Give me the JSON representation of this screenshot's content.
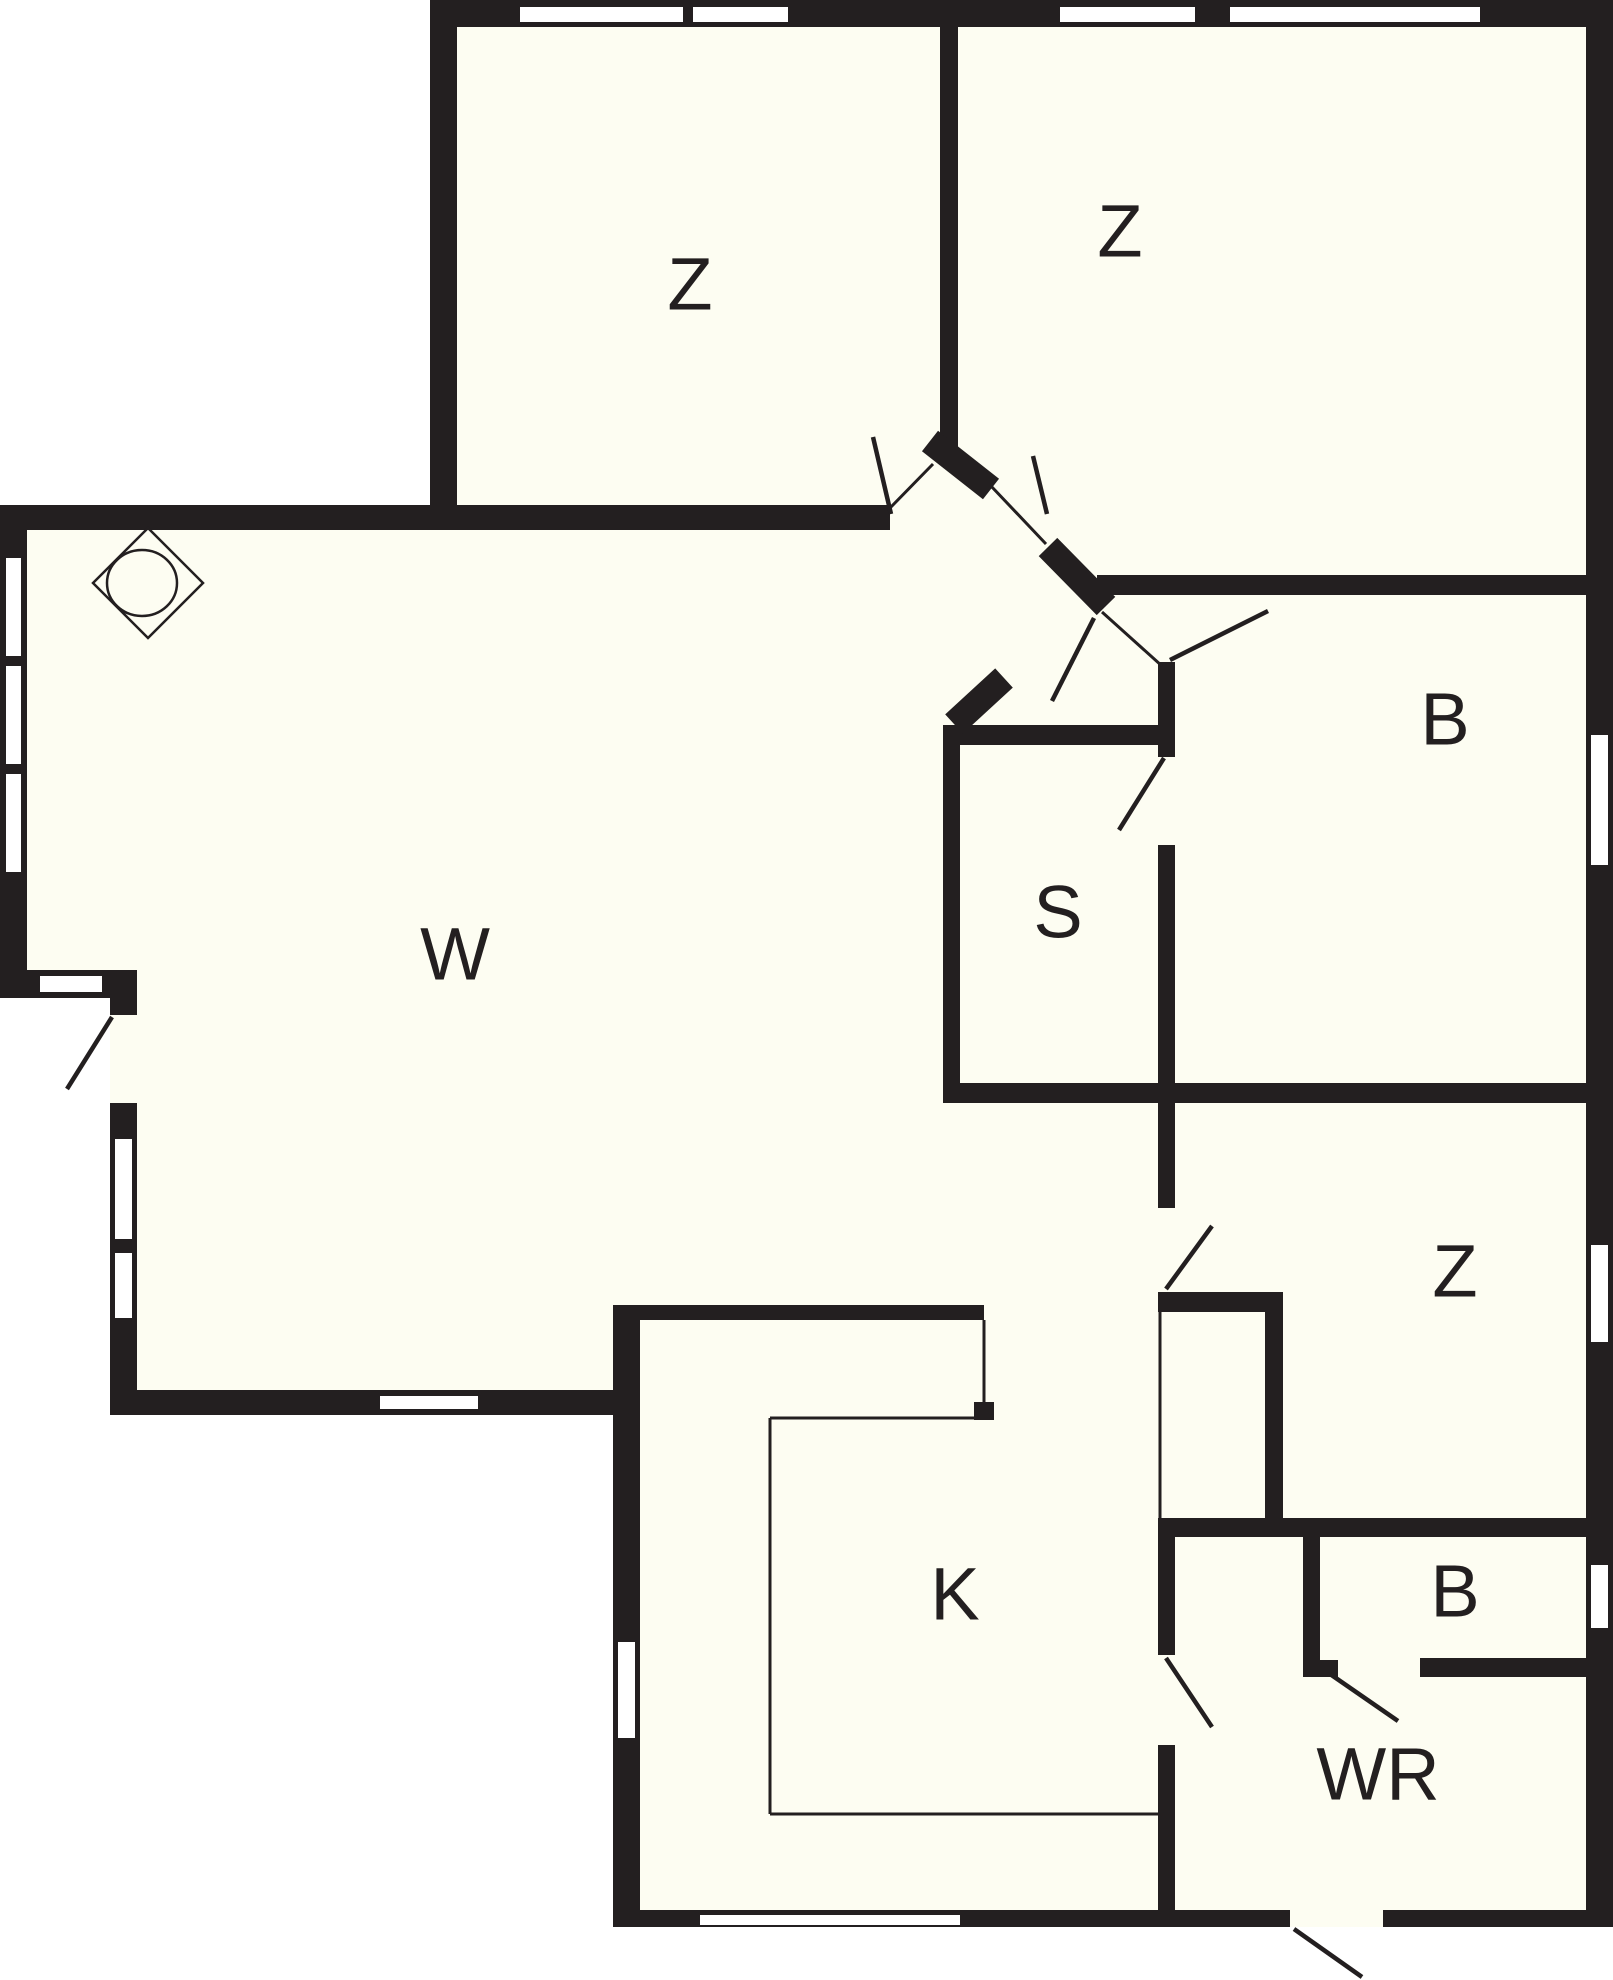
{
  "plan_title": "floor-plan",
  "canvas": {
    "width": 1613,
    "height": 1980
  },
  "colors": {
    "wall": "#231f20",
    "floor": "#fdfdf2",
    "outside": "#ffffff",
    "window": "#ffffff"
  },
  "label_font_size": 74,
  "rooms": [
    {
      "id": "bedroom-1",
      "label": "Z",
      "x": 690,
      "y": 290
    },
    {
      "id": "bedroom-2",
      "label": "Z",
      "x": 1120,
      "y": 237
    },
    {
      "id": "living-room",
      "label": "W",
      "x": 455,
      "y": 960
    },
    {
      "id": "sauna",
      "label": "S",
      "x": 1058,
      "y": 918
    },
    {
      "id": "bathroom-1",
      "label": "B",
      "x": 1445,
      "y": 725
    },
    {
      "id": "bedroom-3",
      "label": "Z",
      "x": 1455,
      "y": 1277
    },
    {
      "id": "kitchen",
      "label": "K",
      "x": 955,
      "y": 1600
    },
    {
      "id": "bathroom-2",
      "label": "B",
      "x": 1455,
      "y": 1597
    },
    {
      "id": "utility-room",
      "label": "WR",
      "x": 1378,
      "y": 1780
    }
  ],
  "floor_outline": [
    [
      430,
      0
    ],
    [
      1613,
      0
    ],
    [
      1613,
      1927
    ],
    [
      613,
      1927
    ],
    [
      613,
      1415
    ],
    [
      110,
      1415
    ],
    [
      110,
      998
    ],
    [
      0,
      998
    ],
    [
      0,
      505
    ],
    [
      430,
      505
    ]
  ],
  "walls": [
    {
      "name": "outer-top-wall",
      "x": 430,
      "y": 0,
      "w": 1183,
      "h": 27
    },
    {
      "name": "outer-right-wall",
      "x": 1586,
      "y": 0,
      "w": 27,
      "h": 1927
    },
    {
      "name": "bedroom1-left-wall",
      "x": 430,
      "y": 0,
      "w": 27,
      "h": 530
    },
    {
      "name": "living-top-wall",
      "x": 0,
      "y": 505,
      "w": 890,
      "h": 25
    },
    {
      "name": "living-left-wall",
      "x": 0,
      "y": 505,
      "w": 27,
      "h": 493
    },
    {
      "name": "living-step-wall",
      "x": 0,
      "y": 970,
      "w": 137,
      "h": 28
    },
    {
      "name": "lowleft-wall-a",
      "x": 110,
      "y": 998,
      "w": 27,
      "h": 17
    },
    {
      "name": "lowleft-wall-b",
      "x": 110,
      "y": 1103,
      "w": 27,
      "h": 312
    },
    {
      "name": "living-bottom-wall",
      "x": 110,
      "y": 1390,
      "w": 530,
      "h": 25
    },
    {
      "name": "kitchen-left-wall",
      "x": 613,
      "y": 1305,
      "w": 27,
      "h": 622
    },
    {
      "name": "bottom-wall-west",
      "x": 613,
      "y": 1910,
      "w": 677,
      "h": 17
    },
    {
      "name": "bottom-wall-east",
      "x": 1383,
      "y": 1910,
      "w": 230,
      "h": 17
    },
    {
      "name": "bedroom-divider-wall",
      "x": 940,
      "y": 27,
      "w": 18,
      "h": 420
    },
    {
      "name": "bath1-top-wall",
      "x": 1097,
      "y": 575,
      "w": 516,
      "h": 20
    },
    {
      "name": "sauna-top-wall",
      "x": 943,
      "y": 725,
      "w": 232,
      "h": 20
    },
    {
      "name": "sauna-left-wall",
      "x": 943,
      "y": 725,
      "w": 17,
      "h": 375
    },
    {
      "name": "sauna-right-wall-up",
      "x": 1158,
      "y": 662,
      "w": 17,
      "h": 95
    },
    {
      "name": "sauna-right-wall-low",
      "x": 1158,
      "y": 845,
      "w": 17,
      "h": 255
    },
    {
      "name": "sauna-bath-bottom-wall",
      "x": 943,
      "y": 1083,
      "w": 670,
      "h": 20
    },
    {
      "name": "corridor-east-wall",
      "x": 1158,
      "y": 1103,
      "w": 17,
      "h": 105
    },
    {
      "name": "corridor-stub-wall",
      "x": 1158,
      "y": 1292,
      "w": 125,
      "h": 20
    },
    {
      "name": "closet-right-wall",
      "x": 1265,
      "y": 1312,
      "w": 18,
      "h": 211
    },
    {
      "name": "utility-top-wall",
      "x": 1158,
      "y": 1518,
      "w": 432,
      "h": 19
    },
    {
      "name": "utility-left-wall-a",
      "x": 1158,
      "y": 1537,
      "w": 17,
      "h": 118
    },
    {
      "name": "utility-left-wall-b",
      "x": 1158,
      "y": 1745,
      "w": 17,
      "h": 165
    },
    {
      "name": "bath2-left-wall",
      "x": 1303,
      "y": 1537,
      "w": 17,
      "h": 140
    },
    {
      "name": "bath2-stub-wall",
      "x": 1303,
      "y": 1660,
      "w": 35,
      "h": 17
    },
    {
      "name": "bath2-bottom-wall",
      "x": 1420,
      "y": 1658,
      "w": 170,
      "h": 19
    },
    {
      "name": "kitchen-top-wall",
      "x": 613,
      "y": 1305,
      "w": 371,
      "h": 15
    },
    {
      "name": "kitchen-counter-cap",
      "x": 974,
      "y": 1402,
      "w": 20,
      "h": 18
    }
  ],
  "diagonal_walls": [
    {
      "name": "hall-jamb-a",
      "x1": 930,
      "y1": 441,
      "x2": 991,
      "y2": 489,
      "w": 26
    },
    {
      "name": "hall-jamb-b",
      "x1": 1048,
      "y1": 547,
      "x2": 1106,
      "y2": 606,
      "w": 26
    },
    {
      "name": "hall-jamb-c",
      "x1": 1004,
      "y1": 678,
      "x2": 954,
      "y2": 724,
      "w": 26
    }
  ],
  "thin_lines": [
    {
      "name": "closet-front-line",
      "x1": 1160,
      "y1": 1312,
      "x2": 1160,
      "y2": 1518
    },
    {
      "name": "counter-line-right",
      "x1": 984,
      "y1": 1320,
      "x2": 984,
      "y2": 1402
    },
    {
      "name": "counter-line-top",
      "x1": 770,
      "y1": 1418,
      "x2": 984,
      "y2": 1418
    },
    {
      "name": "counter-line-left",
      "x1": 770,
      "y1": 1418,
      "x2": 770,
      "y2": 1814
    },
    {
      "name": "counter-line-bottom",
      "x1": 770,
      "y1": 1814,
      "x2": 1158,
      "y2": 1814
    },
    {
      "name": "hall-opening-line-1",
      "x1": 888,
      "y1": 510,
      "x2": 933,
      "y2": 464
    },
    {
      "name": "hall-opening-line-2",
      "x1": 991,
      "y1": 486,
      "x2": 1046,
      "y2": 544
    },
    {
      "name": "hall-opening-line-3",
      "x1": 1102,
      "y1": 612,
      "x2": 1162,
      "y2": 666
    }
  ],
  "door_leaves": [
    {
      "name": "door-bedroom1",
      "x1": 891,
      "y1": 514,
      "x2": 873,
      "y2": 437
    },
    {
      "name": "door-bedroom2",
      "x1": 1033,
      "y1": 456,
      "x2": 1047,
      "y2": 514
    },
    {
      "name": "door-hall-south",
      "x1": 1094,
      "y1": 618,
      "x2": 1052,
      "y2": 701
    },
    {
      "name": "door-bathroom1",
      "x1": 1170,
      "y1": 660,
      "x2": 1268,
      "y2": 611
    },
    {
      "name": "door-sauna",
      "x1": 1164,
      "y1": 758,
      "x2": 1119,
      "y2": 830
    },
    {
      "name": "door-bedroom3",
      "x1": 1166,
      "y1": 1289,
      "x2": 1212,
      "y2": 1226
    },
    {
      "name": "door-utility",
      "x1": 1166,
      "y1": 1658,
      "x2": 1212,
      "y2": 1727
    },
    {
      "name": "door-bathroom2",
      "x1": 1330,
      "y1": 1674,
      "x2": 1398,
      "y2": 1721
    },
    {
      "name": "door-entrance",
      "x1": 1294,
      "y1": 1929,
      "x2": 1362,
      "y2": 1977
    },
    {
      "name": "door-terrace",
      "x1": 112,
      "y1": 1017,
      "x2": 67,
      "y2": 1089
    }
  ],
  "windows": [
    {
      "name": "window-top-1",
      "x": 520,
      "y": 7,
      "w": 163,
      "h": 15
    },
    {
      "name": "window-top-2",
      "x": 693,
      "y": 7,
      "w": 95,
      "h": 15
    },
    {
      "name": "window-top-3",
      "x": 1060,
      "y": 7,
      "w": 135,
      "h": 15
    },
    {
      "name": "window-top-4",
      "x": 1230,
      "y": 7,
      "w": 250,
      "h": 15
    },
    {
      "name": "window-right-1",
      "x": 1591,
      "y": 735,
      "w": 17,
      "h": 130
    },
    {
      "name": "window-right-2",
      "x": 1591,
      "y": 1245,
      "w": 17,
      "h": 97
    },
    {
      "name": "window-right-3",
      "x": 1591,
      "y": 1565,
      "w": 17,
      "h": 63
    },
    {
      "name": "window-left-1",
      "x": 6,
      "y": 558,
      "w": 15,
      "h": 98
    },
    {
      "name": "window-left-2",
      "x": 6,
      "y": 666,
      "w": 15,
      "h": 98
    },
    {
      "name": "window-left-3",
      "x": 6,
      "y": 774,
      "w": 15,
      "h": 98
    },
    {
      "name": "window-step",
      "x": 40,
      "y": 976,
      "w": 62,
      "h": 16
    },
    {
      "name": "window-lowleft-1",
      "x": 115,
      "y": 1139,
      "w": 17,
      "h": 100
    },
    {
      "name": "window-lowleft-2",
      "x": 115,
      "y": 1253,
      "w": 17,
      "h": 65
    },
    {
      "name": "window-living-s",
      "x": 380,
      "y": 1396,
      "w": 98,
      "h": 13
    },
    {
      "name": "window-kitchen-w",
      "x": 618,
      "y": 1642,
      "w": 17,
      "h": 96
    },
    {
      "name": "window-bottom",
      "x": 700,
      "y": 1915,
      "w": 260,
      "h": 10
    }
  ],
  "lamp": {
    "cx": 148,
    "cy": 583,
    "half": 55,
    "r": 33
  }
}
